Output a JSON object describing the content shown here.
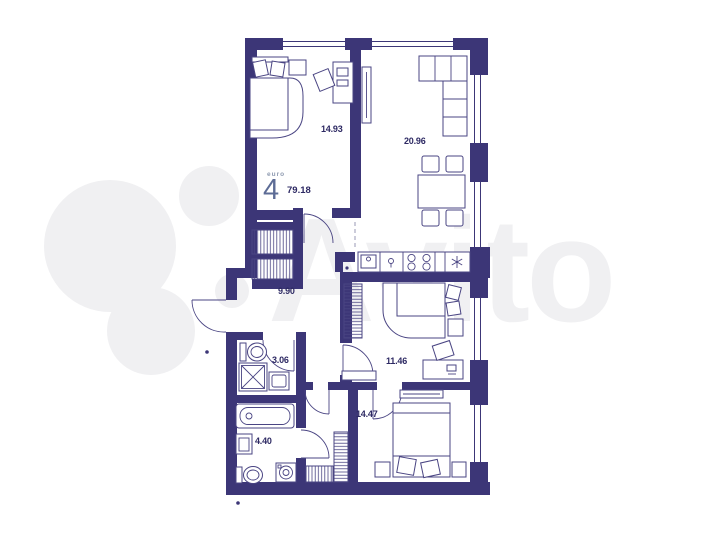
{
  "watermark": {
    "brand": "Avito"
  },
  "unit": {
    "format_label": "euro",
    "rooms_count": "4",
    "total_area": "79.18"
  },
  "rooms": [
    {
      "name": "bedroom-top",
      "area": "14.93"
    },
    {
      "name": "living-kitchen",
      "area": "20.96"
    },
    {
      "name": "hallway",
      "area": "9.90"
    },
    {
      "name": "shower-room",
      "area": "3.06"
    },
    {
      "name": "bedroom-middle",
      "area": "11.46"
    },
    {
      "name": "bathroom",
      "area": "4.40"
    },
    {
      "name": "bedroom-bottom",
      "area": "14.47"
    }
  ],
  "colors": {
    "wall": "#3c3677",
    "furniture_line": "#4a4583",
    "label_ink": "#2d2963",
    "rooms_count_number": "#5d6c96",
    "format_label": "#8e9ab0",
    "watermark": "#f0f0f2"
  }
}
